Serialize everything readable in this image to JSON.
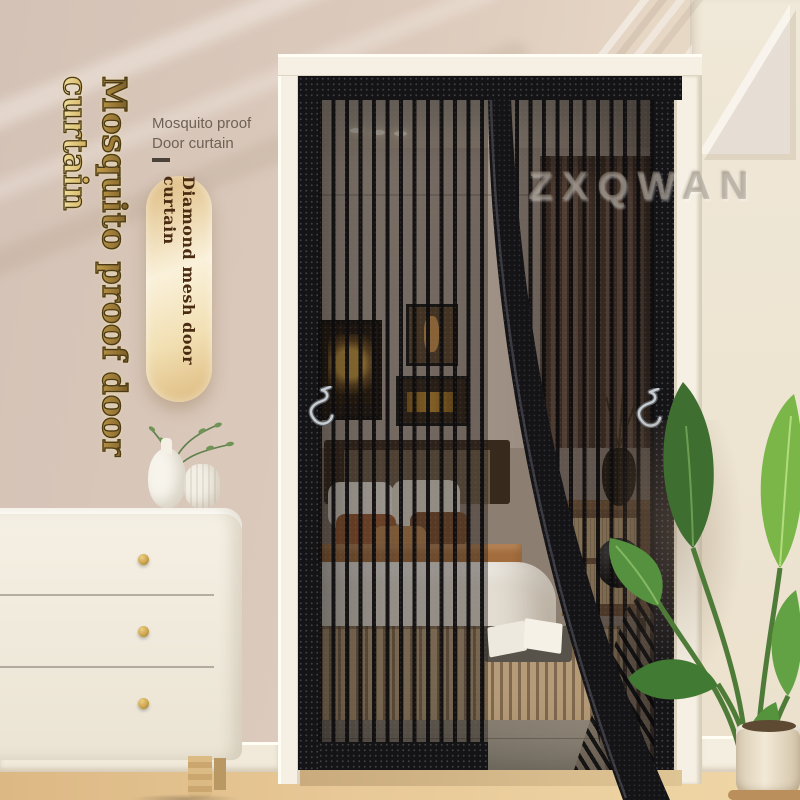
{
  "brand": {
    "watermark": "ZXQWAN"
  },
  "overlay": {
    "vertical_title": "Mosquito proof door curtain",
    "label": {
      "line1": "Mosquito proof",
      "line2": "Door curtain"
    },
    "badge": "Diamond mesh door curtain"
  },
  "icons": {
    "hook": "metal-s-hook",
    "ceiling_light": "recessed-light",
    "logo": "zx-monogram"
  },
  "colors": {
    "gold_light": "#f9eeae",
    "gold_mid": "#c9a24e",
    "gold_dark": "#6d5220",
    "title_outline": "#4a3a16",
    "label_text": "#6e6156",
    "badge_text": "#4a2c12",
    "capsule_light": "#faf1da",
    "capsule_dark": "#ddba7e",
    "curtain_black": "#141316",
    "frame_white": "#f5f0e3",
    "floor_wood": "#dcb884",
    "knob_gold": "#c9a24a",
    "watermark_gray": "rgba(158,148,134,0.5)"
  }
}
